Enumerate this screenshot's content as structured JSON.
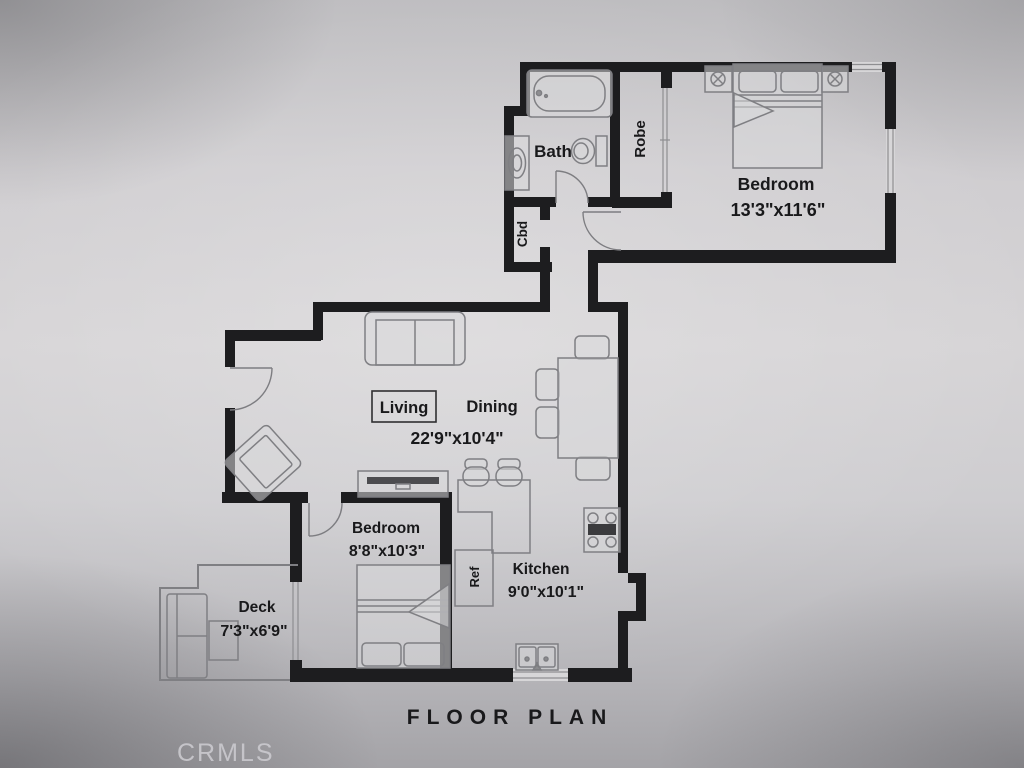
{
  "page": {
    "title_label": "FLOOR PLAN",
    "watermark": "CRMLS"
  },
  "rooms": {
    "bath": {
      "label": "Bath"
    },
    "robe": {
      "label": "Robe"
    },
    "cbd": {
      "label": "Cbd"
    },
    "bedroom_main": {
      "label": "Bedroom",
      "dims": "13'3\"x11'6\""
    },
    "living": {
      "label": "Living"
    },
    "dining": {
      "label": "Dining"
    },
    "living_dining": {
      "dims": "22'9\"x10'4\""
    },
    "bedroom_second": {
      "label": "Bedroom",
      "dims": "8'8\"x10'3\""
    },
    "kitchen": {
      "label": "Kitchen",
      "dims": "9'0\"x10'1\""
    },
    "ref": {
      "label": "Ref"
    },
    "deck": {
      "label": "Deck",
      "dims": "7'3\"x6'9\""
    }
  },
  "colors": {
    "wall": "#1d1d1f",
    "furniture_line": "#7f7f83",
    "fixture_fill": "#d9d8da",
    "window_fill": "#d7d6d8",
    "text": "#19191b",
    "dark_accent": "#4c4c4f",
    "watermark": "#cbcacf"
  }
}
